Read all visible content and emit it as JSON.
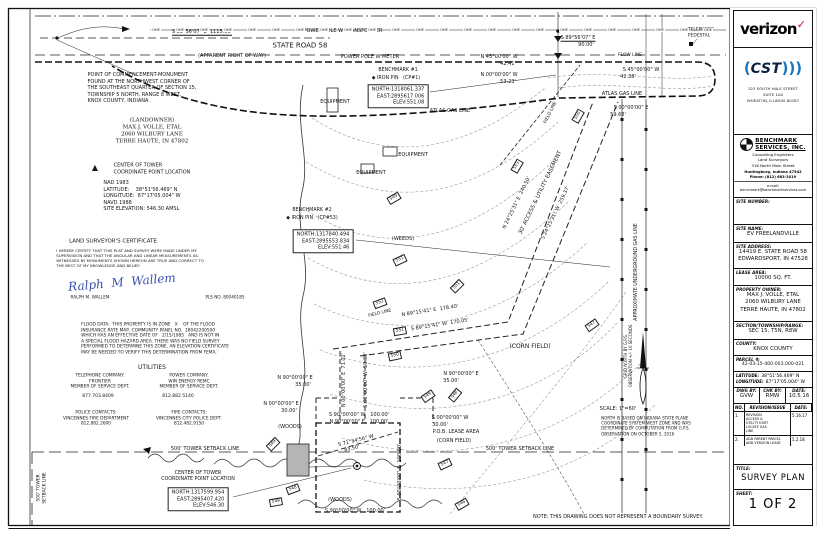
{
  "tb": {
    "verizon": "verizon",
    "verizon_check": "✓",
    "cst_paren_l": "(",
    "cst": "CST",
    "cst_paren_r": ")))",
    "cst_address": "323 SOUTH HALE STREET\nSUITE 100\nWHEATON, ILLINOIS 60187",
    "bm_name": "BENCHMARK\nSERVICES, INC.",
    "bm_sub": "Consulting  Engineers\nLand  Surveyors\n316 North Main Street",
    "bm_sub2": "Huntingburg,  Indiana   47542\nPhone: (812) 683-2019",
    "bm_email": "e-mail: benchmark@benchmarkservices.com",
    "site_number_label": "SITE NUMBER:",
    "site_number": "",
    "site_name_label": "SITE NAME:",
    "site_name": "EV FREELANDVILLE",
    "site_address_label": "SITE ADDRESS:",
    "site_address": "14419 E. STATE ROAD 58\nEDWARDSPORT, IN 47528",
    "lease_area_label": "LEASE AREA:",
    "lease_area": "10000 SQ. FT.",
    "owner_label": "PROPERTY OWNER:",
    "owner": "MAX J. VOLLE, ETAL\n2060 WILBURY LANE\nTERRE HAUTE, IN 47802",
    "str_label": "SECTION/TOWNSHIP/RANGE:",
    "str": "SEC 15, T5N, R8W",
    "county_label": "COUNTY:",
    "county": "KNOX COUNTY",
    "parcel_label": "PARCEL #:",
    "parcel": "42-03-15-400-003.000-021",
    "lat_label": "LATITUDE:",
    "lat": "38°51'56.469\" N",
    "lon_label": "LONGITUDE:",
    "lon": "87°17'05.004\" W",
    "dwg_label": "DWG BY:",
    "dwg": "GVW",
    "chk_label": "CHK BY:",
    "chk": "RMW",
    "date_label": "DATE:",
    "date": "10.5.16",
    "rev_no_label": "NO.",
    "rev_issue_label": "REVISION/ISSUE",
    "rev_date_label": "DATE:",
    "revisions": [
      {
        "no": "1.",
        "desc": "REVISION\nACCESS &\nUTILITY ESMT\nLOCATE GAS\nLINE",
        "date": "5.16.17"
      },
      {
        "no": "2.",
        "desc": "ADD PARENT PARCEL\nAND VERIZON LEASE",
        "date": "5.2.18"
      }
    ],
    "title_label": "TITLE:",
    "title": "SURVEY PLAN",
    "sheet_label": "SHEET:",
    "sheet": "1 OF 2"
  },
  "drawing": {
    "ohe": {
      "text": "OHE",
      "y": 30,
      "x_start": 156,
      "spacing": 24,
      "count": 24
    },
    "labels": [
      {
        "t": "S 89°56'07\" E  1115.66'",
        "x": 202,
        "y": 32,
        "cls": "u"
      },
      {
        "t": "STATE ROAD 58",
        "x": 300,
        "y": 46,
        "s": 7
      },
      {
        "t": "(APPARENT RIGHT OF WAY)",
        "x": 232,
        "y": 56
      },
      {
        "t": "POWER POLE W TRANSFORMER",
        "x": 343,
        "y": 31
      },
      {
        "t": "POWER POLE W METER",
        "x": 370,
        "y": 57
      },
      {
        "t": "S 89°56'07\" E",
        "x": 578,
        "y": 38,
        "cls": "u"
      },
      {
        "t": "90.00'",
        "x": 586,
        "y": 45
      },
      {
        "t": "TELEPHONE\nPEDESTAL",
        "x": 701,
        "y": 33,
        "s": 4.4,
        "cls": "L"
      },
      {
        "t": "FLOW LINE",
        "x": 630,
        "y": 56,
        "s": 4.4
      },
      {
        "t": "N 45°00'00\" W",
        "x": 499,
        "y": 57
      },
      {
        "t": "42.41'",
        "x": 508,
        "y": 64
      },
      {
        "t": "N 00°00'00\" W",
        "x": 499,
        "y": 75
      },
      {
        "t": "53.23'",
        "x": 508,
        "y": 82
      },
      {
        "t": "S 45°00'00\" W",
        "x": 641,
        "y": 70
      },
      {
        "t": "42.38'",
        "x": 628,
        "y": 77
      },
      {
        "t": "ATLAS GAS LINE",
        "x": 622,
        "y": 94
      },
      {
        "t": "S 00°00'00\" E",
        "x": 631,
        "y": 108
      },
      {
        "t": "59.68'",
        "x": 618,
        "y": 115
      },
      {
        "t": "ATLAS GAS LINE",
        "x": 450,
        "y": 111
      },
      {
        "t": "BENCHMARK #1",
        "x": 398,
        "y": 71,
        "s": 4.8
      },
      {
        "t": "◆ IRON PIN   (CP#1)",
        "x": 396,
        "y": 79,
        "s": 4.8
      },
      {
        "t": "NORTH:1318061.337\nEAST:2895617.006\nELEV:551.08",
        "x": 398,
        "y": 96,
        "cls": "box"
      },
      {
        "t": "EQUIPMENT",
        "x": 335,
        "y": 102
      },
      {
        "t": "EQUIPMENT",
        "x": 413,
        "y": 155
      },
      {
        "t": "EQUIPMENT",
        "x": 371,
        "y": 173
      },
      {
        "t": "BENCHMARK #2",
        "x": 312,
        "y": 211,
        "s": 4.8
      },
      {
        "t": "◆ IRON PIN   (CP#53)",
        "x": 312,
        "y": 219,
        "s": 4.8
      },
      {
        "t": "NORTH:1317840.494\nEAST:2895553.834\nELEV:551.46",
        "x": 323,
        "y": 241,
        "cls": "box"
      },
      {
        "t": "(WEEDS)",
        "x": 403,
        "y": 239
      },
      {
        "t": "N 24°25'31\" E  240.50'",
        "x": 517,
        "y": 203,
        "r": -64
      },
      {
        "t": "30' ACCESS & UTILITY EASEMENT",
        "x": 541,
        "y": 193,
        "r": -64,
        "s": 5.5
      },
      {
        "t": "S 24°25'31\" W  259.37'",
        "x": 556,
        "y": 213,
        "r": -64
      },
      {
        "t": "FIELD LINE",
        "x": 551,
        "y": 113,
        "r": -64,
        "s": 4.4
      },
      {
        "t": "FIELD LINE",
        "x": 380,
        "y": 314,
        "r": -14,
        "s": 4.4
      },
      {
        "t": "N 89°15'41\" E  178.40'",
        "x": 430,
        "y": 311,
        "r": -9
      },
      {
        "t": "S 89°15'41\" W  170.05'",
        "x": 440,
        "y": 325,
        "r": -9
      },
      {
        "t": "(CORN FIELD)",
        "x": 530,
        "y": 347,
        "s": 6
      },
      {
        "t": "(CORN FIELD)",
        "x": 454,
        "y": 441
      },
      {
        "t": "N 00°00'00\" E  71.02'",
        "x": 344,
        "y": 380,
        "r": -90
      },
      {
        "t": "S 00°00'00\" W  50.30'",
        "x": 366,
        "y": 380,
        "r": -90
      },
      {
        "t": "N 90°00'00\" E",
        "x": 295,
        "y": 378
      },
      {
        "t": "35.00'",
        "x": 303,
        "y": 385
      },
      {
        "t": "N 00°00'00\" E",
        "x": 281,
        "y": 404
      },
      {
        "t": "30.00'",
        "x": 289,
        "y": 411
      },
      {
        "t": "(WOODS)",
        "x": 290,
        "y": 427
      },
      {
        "t": "S 90°00'00\" W   100.00'",
        "x": 359,
        "y": 415
      },
      {
        "t": "N 90°00'00\" E   100.00'",
        "x": 359,
        "y": 422
      },
      {
        "t": "S 71°34'56\" W",
        "x": 356,
        "y": 441,
        "r": -14
      },
      {
        "t": "83.50'",
        "x": 352,
        "y": 449,
        "r": -14
      },
      {
        "t": "S 00°00'00\" W",
        "x": 450,
        "y": 418
      },
      {
        "t": "30.00'",
        "x": 440,
        "y": 425
      },
      {
        "t": "P.O.B. LEASE AREA",
        "x": 456,
        "y": 432
      },
      {
        "t": "N 90°00'00\" E",
        "x": 461,
        "y": 374
      },
      {
        "t": "35.00'",
        "x": 451,
        "y": 381
      },
      {
        "t": "S 00°00'00\" E  100.00'",
        "x": 400,
        "y": 472,
        "r": -90
      },
      {
        "t": "S 90°00'00\" W   100.00'",
        "x": 355,
        "y": 511
      },
      {
        "t": "(WOODS)",
        "x": 340,
        "y": 500
      },
      {
        "t": "500' TOWER SETBACK LINE",
        "x": 205,
        "y": 449
      },
      {
        "t": "500' TOWER SETBACK LINE",
        "x": 520,
        "y": 449
      },
      {
        "t": "500' TOWER\nSETBACK LINE",
        "x": 42,
        "y": 488,
        "r": -90,
        "s": 4.4
      },
      {
        "t": "CENTER OF TOWER\nCOORDINATE POINT LOCATION",
        "x": 198,
        "y": 477,
        "s": 4.8
      },
      {
        "t": "NORTH:1317599.954\nEAST:2895407.420\nELEV:546.30",
        "x": 198,
        "y": 499,
        "cls": "box"
      },
      {
        "t": "NOTE: THIS DRAWING DOES NOT REPRESENT A BOUNDARY SURVEY.",
        "x": 618,
        "y": 517,
        "s": 5
      },
      {
        "t": "SCALE: 1\"=60'",
        "x": 618,
        "y": 409,
        "s": 5
      },
      {
        "t": "NORTH IS BASED ON INDIANA STATE PLANE\nCOORDINATE SYSTEM WEST ZONE AND WAS\nDETERMINED BY COMPUTATION FROM G.P.S.\nOBSERVATION ON OCTOBER 5, 2016",
        "x": 646,
        "y": 426,
        "s": 4,
        "cls": "L"
      },
      {
        "t": "GRID NORTH BY G.P.S.\nOBSERVATION +/- 10 SECONDS",
        "x": 628,
        "y": 356,
        "r": -90,
        "s": 4
      },
      {
        "t": "APPROXIMATE UNDERGROUND GAS LINE",
        "x": 637,
        "y": 272,
        "r": -90,
        "s": 4.8
      },
      {
        "t": "POINT OF COMMENCEMENT-MONUMENT\nFOUND AT THE NORTHWEST CORNER OF\nTHE SOUTHEAST QUARTER OF SECTION 15,\nTOWNSHIP 5 NORTH, RANGE 8 WEST,\nKNOX COUNTY, INDIANA",
        "x": 142,
        "y": 88,
        "cls": "L"
      },
      {
        "t": "(LANDOWNER)\nMAX J. VOLLE, ETAL\n2060 WILBURY LANE\nTERRE HAUTE, IN 47802",
        "x": 152,
        "y": 132,
        "s": 5.5,
        "cls": "serif"
      },
      {
        "t": "▲",
        "x": 95,
        "y": 168,
        "s": 8
      },
      {
        "t": "CENTER OF TOWER\nCOORDINATE POINT LOCATION",
        "x": 152,
        "y": 169,
        "cls": "L"
      },
      {
        "t": "NAD 1983\nLATITUDE:    38°51'56.469\" N\nLONGITUDE:  87°17'05.004\" W\nNAVD 1988\nSITE ELEVATION: 546.30 AMSL",
        "x": 142,
        "y": 196,
        "cls": "L"
      },
      {
        "t": "LAND SURVEYOR'S CERTIFICATE",
        "x": 113,
        "y": 242,
        "s": 5.5
      },
      {
        "t": "I HEREBY CERTIFY THAT THIS PLAT AND SURVEY WERE MADE UNDER MY\nSUPERVISION AND THAT THE ANGULAR AND LINEAR MEASUREMENTS AS\nWITNESSED BY MONUMENTS SHOWN HEREON ARE TRUE AND CORRECT TO\nTHE BEST OF MY KNOWLEDGE AND BELIEF.",
        "x": 130,
        "y": 258,
        "s": 3.9,
        "cls": "L"
      },
      {
        "t": "Ralph  M  Wallem",
        "x": 122,
        "y": 283,
        "s": 12,
        "cls": "sig"
      },
      {
        "t": "RALPH M. WALLEM",
        "x": 90,
        "y": 297,
        "s": 4.2
      },
      {
        "t": "PLS NO. 80040185",
        "x": 225,
        "y": 297,
        "s": 4.2
      },
      {
        "t": "FLOOD DATA:  THIS PROPERTY IS IN ZONE   X    OF THE FLOOD\nINSURANCE RATE MAP, COMMUNITY PANEL NO.  18042200500\nWHICH HAS AN EFFECTIVE DATE OF   2/15/1985   AND IS NOT IN\nA SPECIAL FLOOD HAZARD AREA. THERE WAS NO FIELD SURVEY\nPERFORMED TO DETERMINE THIS ZONE. AN ELEVATION CERTIFICATE\nMAY BE NEEDED TO VERIFY THIS DETERMINATION FROM FEMA.",
        "x": 155,
        "y": 339,
        "s": 4.3,
        "cls": "L"
      },
      {
        "t": "UTILITIES",
        "x": 152,
        "y": 368,
        "s": 6
      },
      {
        "t": "TELEPHONE COMPANY:\nFRONTIER\nMEMBER OF SERVICE DEPT.",
        "x": 100,
        "y": 382,
        "s": 4.3
      },
      {
        "t": "877.703.8409",
        "x": 98,
        "y": 397,
        "s": 4.5
      },
      {
        "t": "POWER COMPANY:\nWIN ENERGY REMC\nMEMBER OF SERVICE DEPT.",
        "x": 189,
        "y": 382,
        "s": 4.3
      },
      {
        "t": "812.882.5140",
        "x": 178,
        "y": 397,
        "s": 4.5
      },
      {
        "t": "POLICE CONTACTS:\nVINCENNES FIRE DEPARTMENT\n812.882.2600",
        "x": 96,
        "y": 419,
        "s": 4.3
      },
      {
        "t": "FIRE CONTACTS:\nVINCENNES CITY POLICE DEPT.\n812.482.9150",
        "x": 189,
        "y": 419,
        "s": 4.3
      },
      {
        "t": "550",
        "x": 578,
        "y": 116,
        "r": -60,
        "cls": "cbox"
      },
      {
        "t": "553",
        "x": 517,
        "y": 166,
        "r": -60,
        "cls": "cbox"
      },
      {
        "t": "549",
        "x": 394,
        "y": 198,
        "r": -30,
        "cls": "cbox"
      },
      {
        "t": "551",
        "x": 400,
        "y": 260,
        "r": -25,
        "cls": "cbox"
      },
      {
        "t": "551",
        "x": 457,
        "y": 286,
        "r": -45,
        "cls": "cbox"
      },
      {
        "t": "552",
        "x": 380,
        "y": 303,
        "r": -20,
        "cls": "cbox"
      },
      {
        "t": "551",
        "x": 400,
        "y": 331,
        "r": -10,
        "cls": "cbox"
      },
      {
        "t": "550",
        "x": 395,
        "y": 356,
        "r": -12,
        "cls": "cbox"
      },
      {
        "t": "549",
        "x": 428,
        "y": 396,
        "r": -35,
        "cls": "cbox"
      },
      {
        "t": "548",
        "x": 455,
        "y": 395,
        "r": -50,
        "cls": "cbox"
      },
      {
        "t": "547",
        "x": 592,
        "y": 325,
        "r": -35,
        "cls": "cbox"
      },
      {
        "t": "547",
        "x": 445,
        "y": 464,
        "r": -25,
        "cls": "cbox"
      },
      {
        "t": "546",
        "x": 462,
        "y": 504,
        "r": -30,
        "cls": "cbox"
      },
      {
        "t": "548",
        "x": 293,
        "y": 489,
        "r": -20,
        "cls": "cbox"
      },
      {
        "t": "549",
        "x": 276,
        "y": 502,
        "r": -10,
        "cls": "cbox"
      },
      {
        "t": "549",
        "x": 273,
        "y": 444,
        "r": -45,
        "cls": "cbox"
      }
    ]
  }
}
